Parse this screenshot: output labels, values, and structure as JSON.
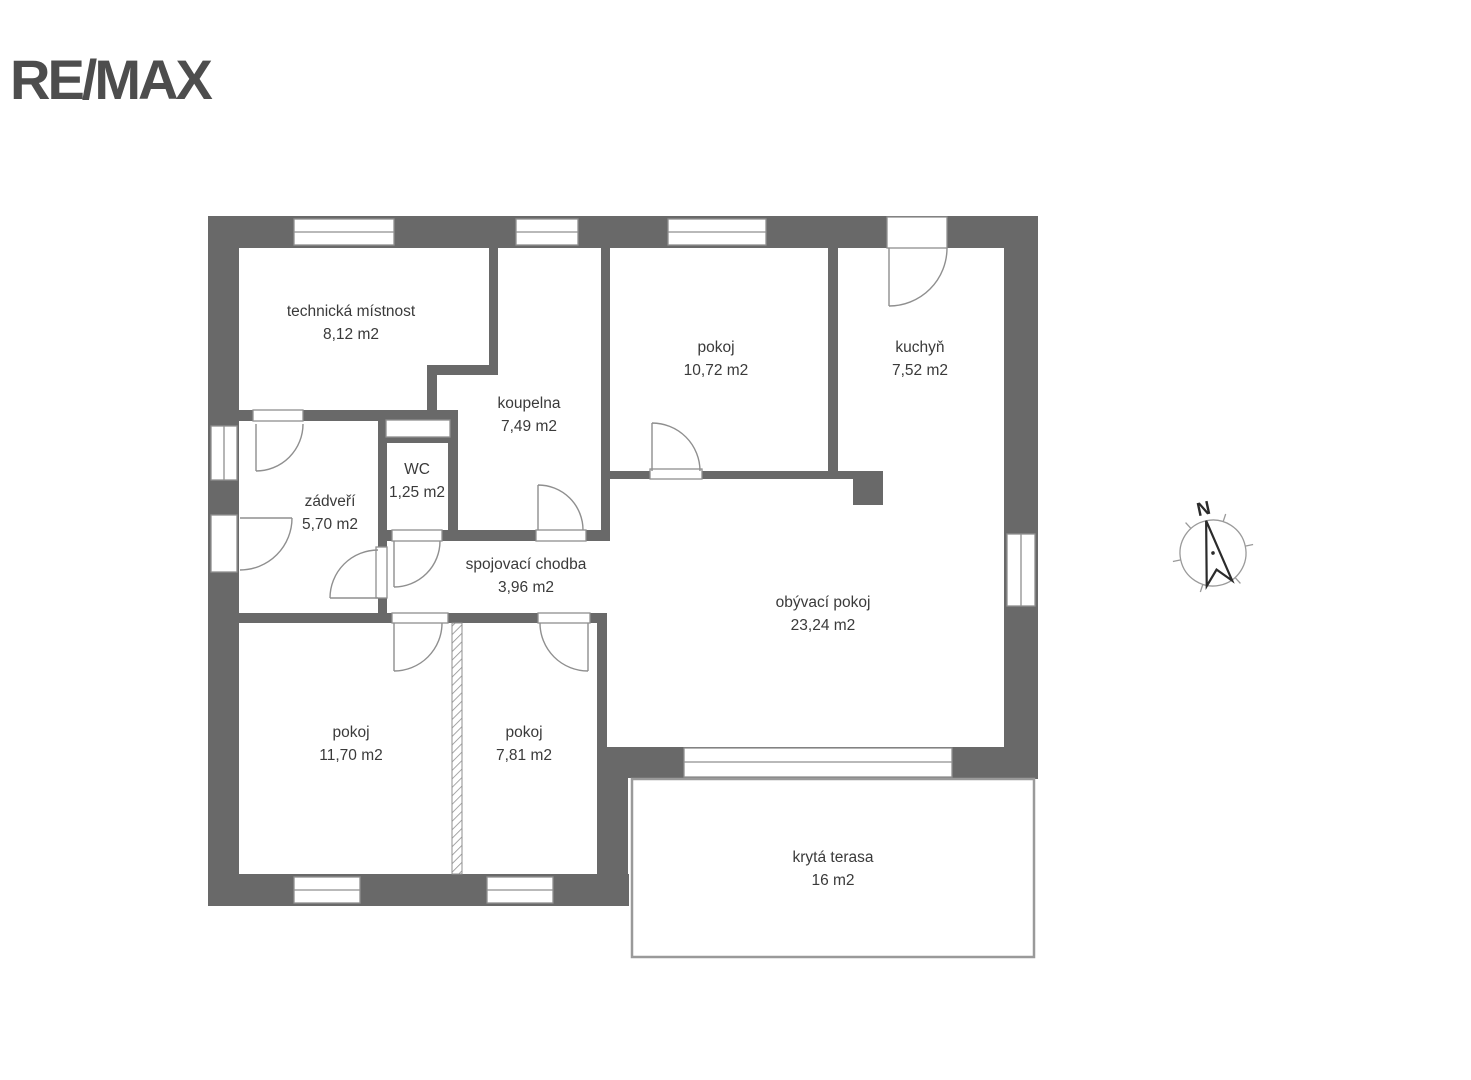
{
  "logo": {
    "text": "RE/MAX"
  },
  "compass": {
    "north_label": "N"
  },
  "rooms": [
    {
      "name": "technická místnost",
      "area": "8,12 m2"
    },
    {
      "name": "koupelna",
      "area": "7,49 m2"
    },
    {
      "name": "WC",
      "area": "1,25 m2"
    },
    {
      "name": "zádveří",
      "area": "5,70 m2"
    },
    {
      "name": "spojovací chodba",
      "area": "3,96 m2"
    },
    {
      "name": "pokoj",
      "area": "10,72 m2"
    },
    {
      "name": "kuchyň",
      "area": "7,52 m2"
    },
    {
      "name": "obývací pokoj",
      "area": "23,24 m2"
    },
    {
      "name": "pokoj",
      "area": "11,70 m2"
    },
    {
      "name": "pokoj",
      "area": "7,81 m2"
    },
    {
      "name": "krytá terasa",
      "area": "16 m2"
    }
  ],
  "colors": {
    "wall": "#696969",
    "thin_line": "#8f8f8f",
    "text": "#3a3a3a",
    "logo": "#4d4d4d",
    "background": "#ffffff"
  }
}
